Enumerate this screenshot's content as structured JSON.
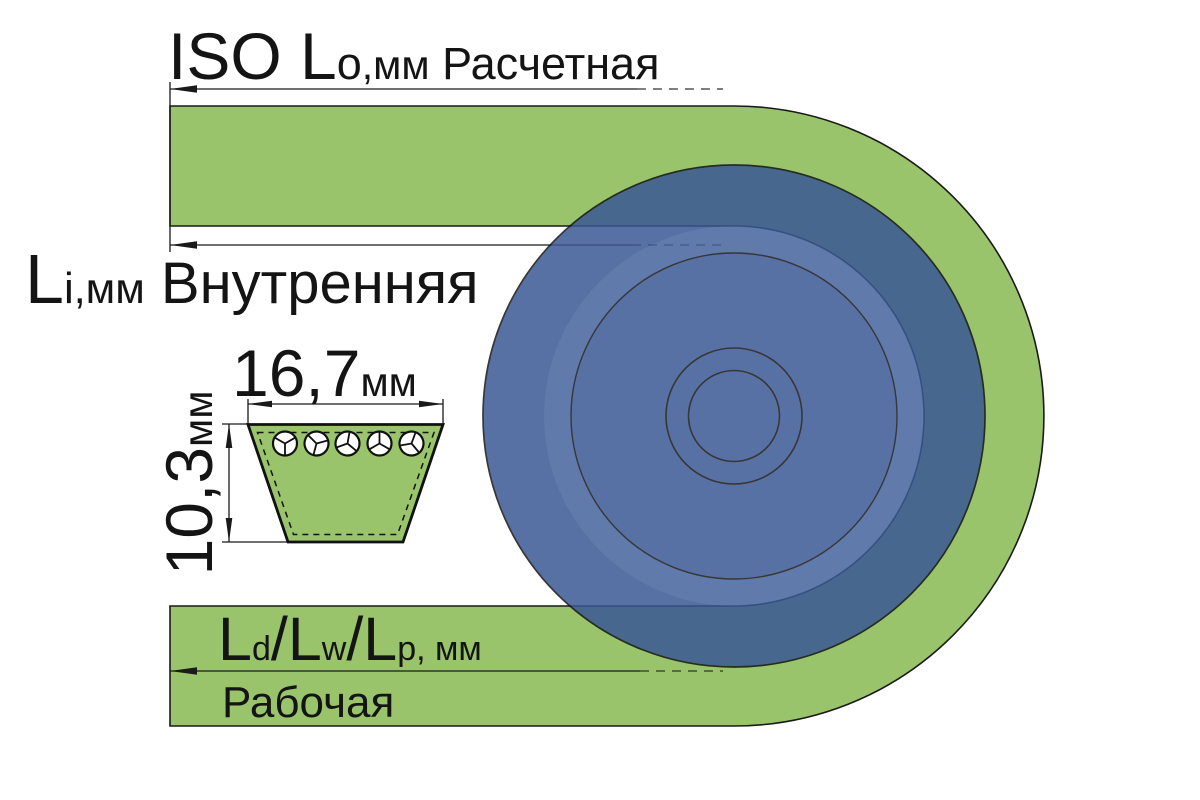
{
  "labels": {
    "outer": {
      "main": "ISO L",
      "sub": "o",
      "unit": ",мм",
      "desc": " Расчетная"
    },
    "inner": {
      "main": "L",
      "sub": "i",
      "unit": ",мм",
      "desc": " Внутренняя"
    },
    "pitch": {
      "m1": "L",
      "s1": "d",
      "sl1": "/",
      "m2": "L",
      "s2": "w",
      "sl2": "/",
      "m3": "L",
      "s3": "p",
      "unit": ", мм"
    },
    "working": "Рабочая"
  },
  "dimensions": {
    "top_width": {
      "value": "16,7",
      "unit": "мм"
    },
    "height": {
      "value": "10,3",
      "unit": "мм"
    }
  },
  "cross_section": {
    "cord_count": 5
  },
  "colors": {
    "background": "#FFFFFF",
    "belt_green": "#9AC46B",
    "pulley_blue": "#395695",
    "pulley_face": "#42619D",
    "outline": "#1A1A1A"
  }
}
